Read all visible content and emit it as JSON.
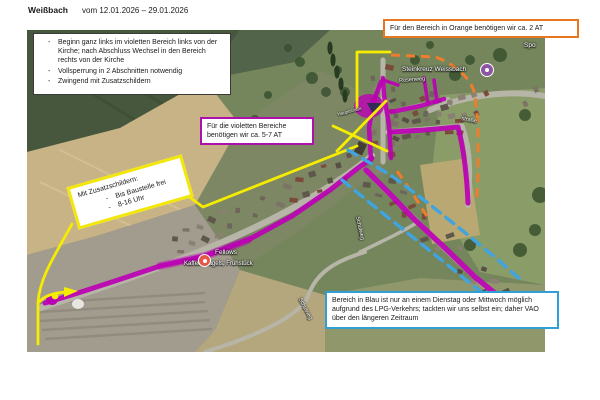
{
  "header": {
    "title": "Weißbach",
    "date_range": "vom 12.01.2026 – 29.01.2026"
  },
  "notes_box": {
    "items": [
      "Beginn ganz links im violetten Bereich links von der Kirche; nach Abschluss Wechsel in den Bereich rechts von der Kirche",
      "Vollsperrung in 2 Abschnitten notwendig",
      "Zwingend mit Zusatzschildern"
    ]
  },
  "callouts": {
    "orange": {
      "text": "Für den Bereich in Orange benötigen wir ca. 2 AT"
    },
    "violet": {
      "text": "Für die violetten Bereiche benötigen wir ca. 5-7 AT"
    },
    "yellow": {
      "title": "Mit Zusatzschildern:",
      "items": [
        "Bis Baustelle frei",
        "8-16 Uhr"
      ]
    },
    "blue": {
      "text": "Bereich in Blau ist nur an einem Dienstag oder Mittwoch möglich aufgrund des LPG-Verkehrs; tackten wir uns selbst ein; daher VAO über den längeren Zeitraum"
    }
  },
  "map": {
    "labels": {
      "poi_steinkreuz": "Steinkreuz Weissbach",
      "fellows_name": "Fellows",
      "fellows_subtitle": "Kaffee, Bagels, Frühstück",
      "street_rosenweg": "Rosenweg",
      "street_strasse_partial": "straße",
      "street_schulweg": "Schulweg",
      "street_main": "Hauptstraße",
      "sportplatz_partial": "Spo"
    },
    "colors": {
      "route_violet": "#bb00b4",
      "route_yellow": "#f6ec00",
      "route_orange": "#ef7d2c",
      "route_blue": "#3fa4e0",
      "box_orange": "#e87722",
      "box_violet": "#ae10ae",
      "box_blue": "#2f9fd6",
      "box_yellow": "#f2e60a",
      "poi_purple": "#8d56a3",
      "poi_red": "#e4584a"
    }
  }
}
